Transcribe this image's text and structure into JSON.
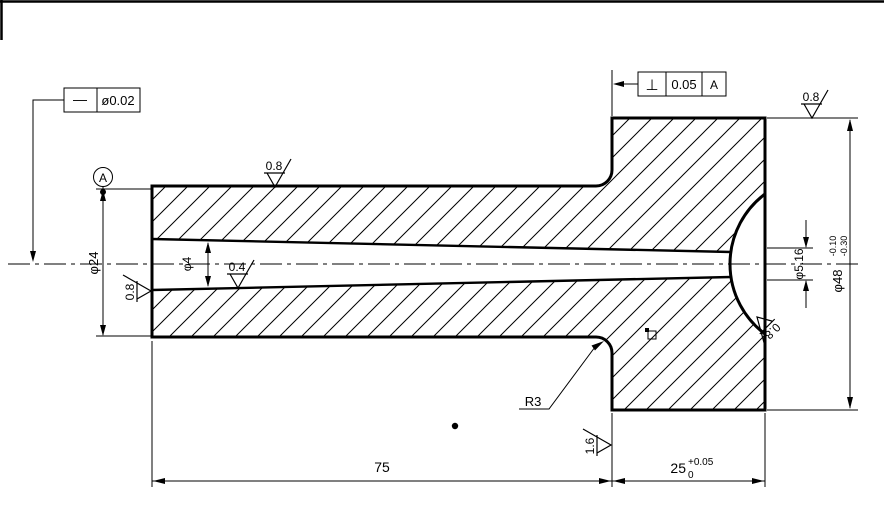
{
  "frames": {
    "straightness": {
      "symbol": "—",
      "tolerance": "ø0.02"
    },
    "perpendicularity": {
      "symbol": "⊥",
      "tolerance": "0.05",
      "datum": "A"
    }
  },
  "datum": {
    "label": "A"
  },
  "roughness": {
    "top": "0.8",
    "flange_top": "0.8",
    "bore_left": "0.8",
    "bore_inner": "0.4",
    "sphere": "0.8",
    "shoulder": "1.6"
  },
  "dimensions": {
    "outer_diameter": "φ24",
    "bore_small": "φ4",
    "bore_large": "φ5.16",
    "flange_diameter": "φ48",
    "flange_tol_upper": "-0.10",
    "flange_tol_lower": "-0.30",
    "body_length": "75",
    "flange_width": "25",
    "flange_width_tol_upper": "+0.05",
    "flange_width_tol_lower": "0",
    "fillet_radius": "R3"
  }
}
